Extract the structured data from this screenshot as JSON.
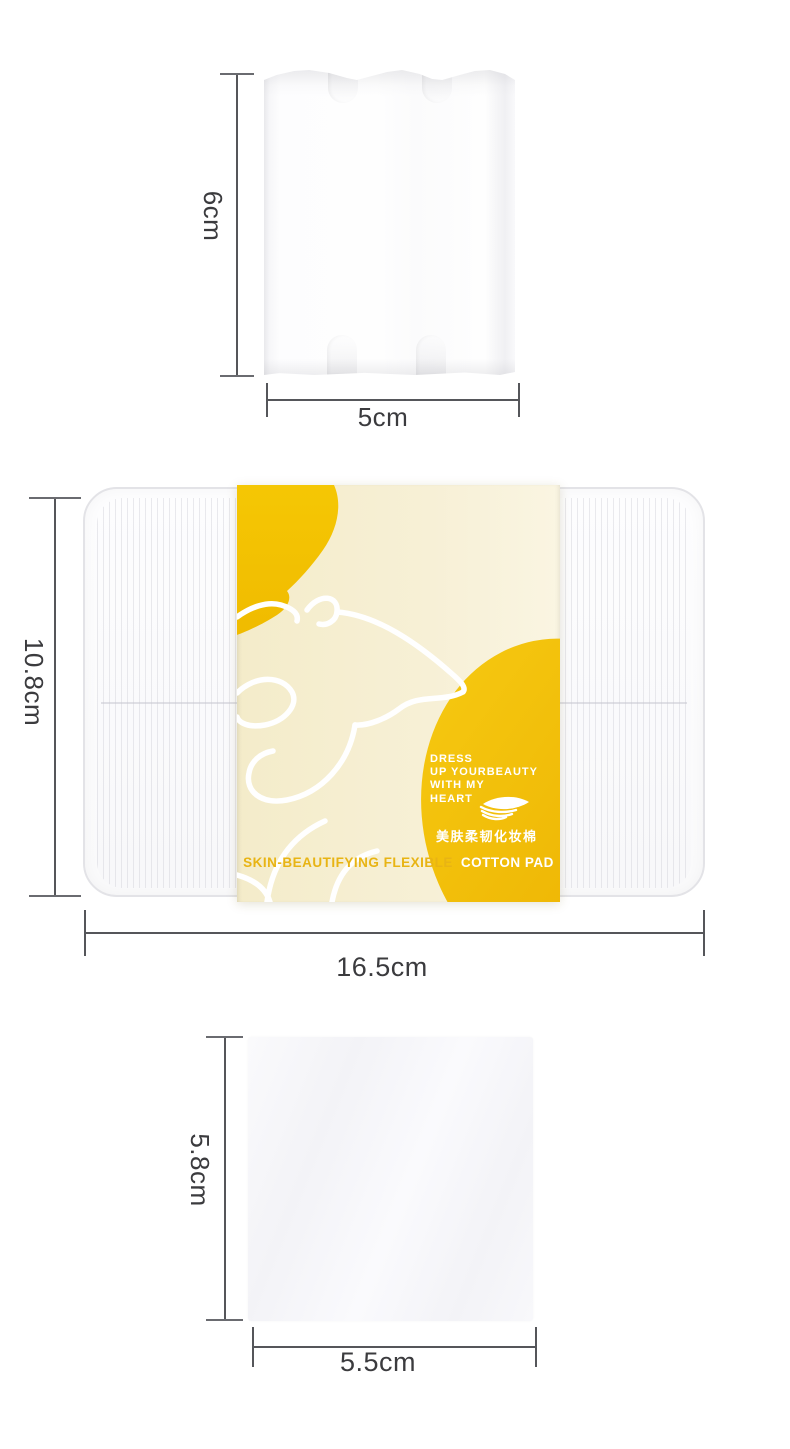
{
  "figure_top": {
    "height_label": "6cm",
    "width_label": "5cm"
  },
  "figure_package": {
    "height_label": "10.8cm",
    "width_label": "16.5cm",
    "label": {
      "tagline": [
        "DRESS",
        "UP YOURBEAUTY",
        "WITH MY",
        "HEART"
      ],
      "cn_name": "美肤柔韧化妆棉",
      "en_name_left": "SKIN-BEAUTIFYING FLEXIBLE",
      "en_name_right": "COTTON PAD"
    }
  },
  "figure_bottom": {
    "height_label": "5.8cm",
    "width_label": "5.5cm"
  },
  "icons": {
    "pad_stack": "cotton-pad-stack-icon"
  },
  "colors": {
    "accent_yellow": "#F2C200",
    "cream": "#F6EFD3",
    "measure_line": "#55565A",
    "label_text": "#3B3B3E"
  }
}
